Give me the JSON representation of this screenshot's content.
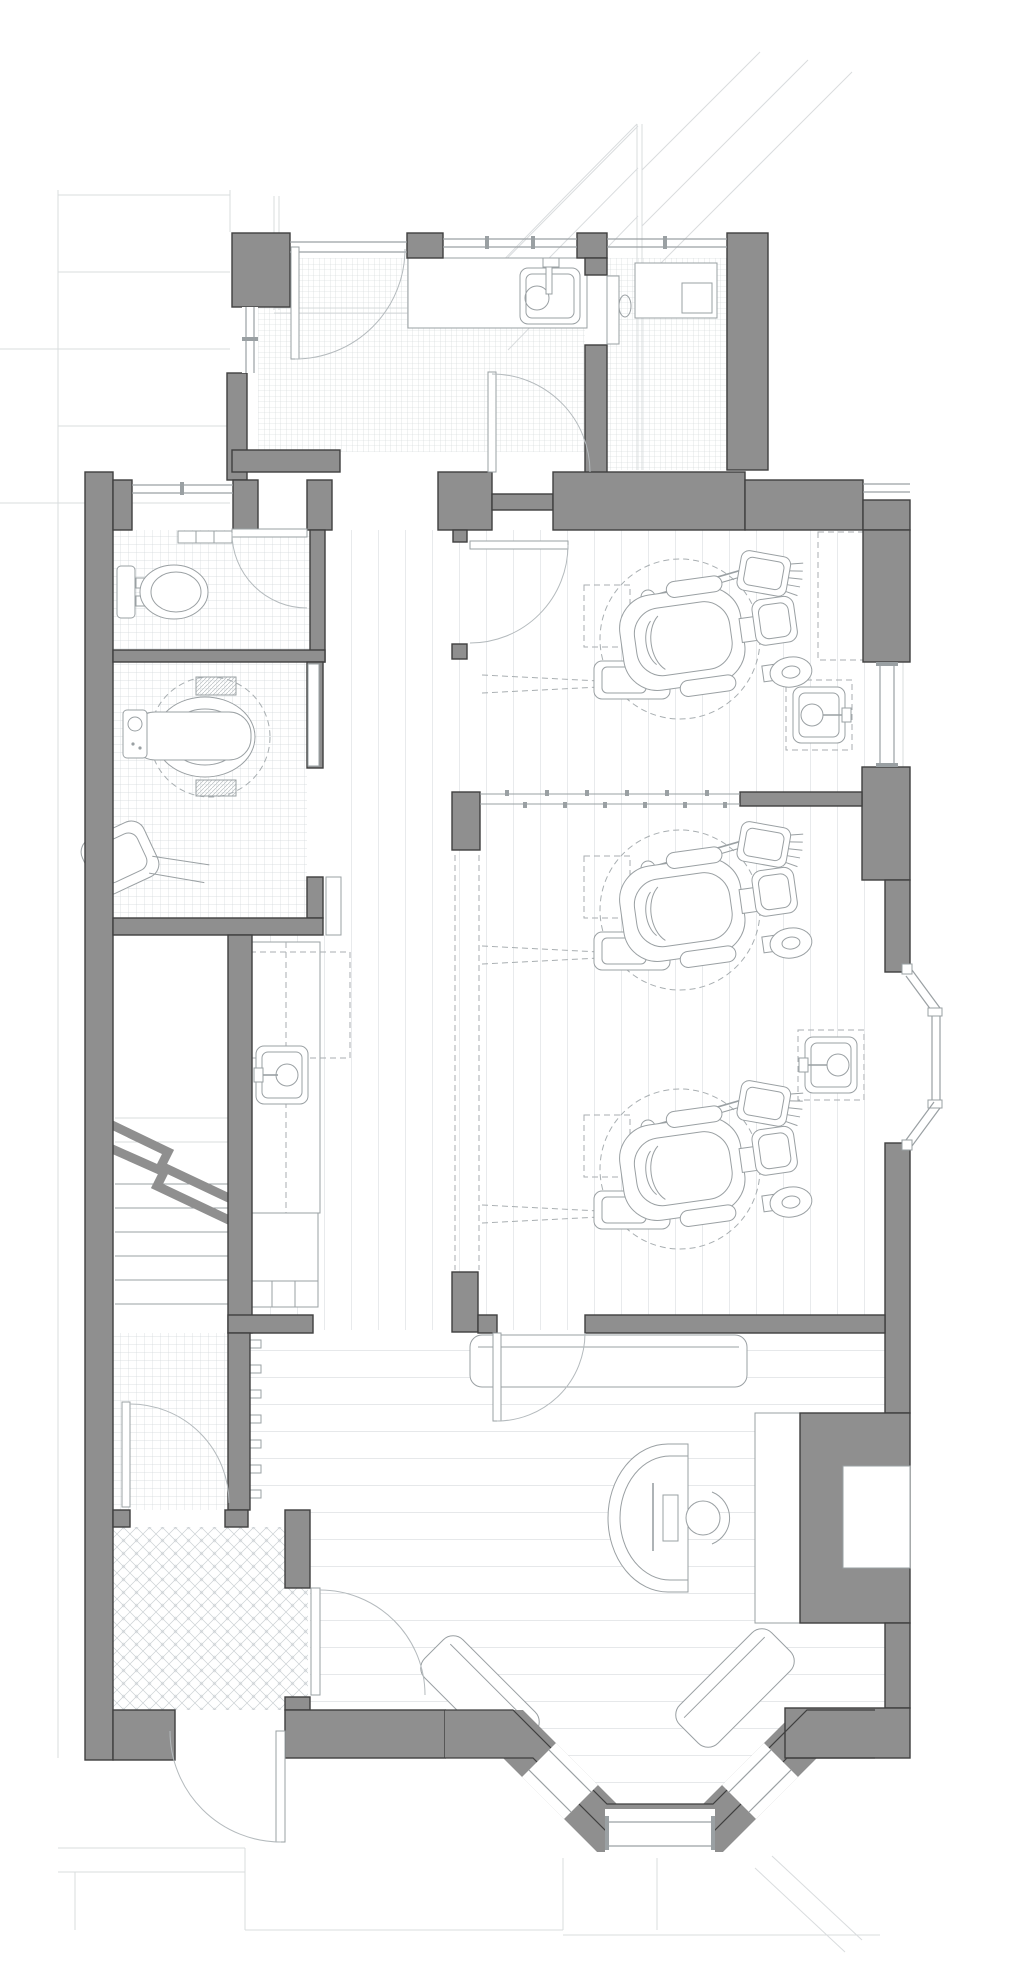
{
  "canvas": {
    "width": 1024,
    "height": 1987
  },
  "palette": {
    "background": "#ffffff",
    "wall_fill": "#8f8f8f",
    "wall_outline": "#3f3f3f",
    "fixture_line": "#9aa0a3",
    "dashed_line": "#a8aeb1",
    "swing_arc": "#b4babd",
    "context_faint": "#d9dcde",
    "tile_line": "#d2d7da",
    "plank_line": "#ccd1d4"
  },
  "fixtures": {
    "dental_chairs": [
      {
        "x": 570,
        "y": 557
      },
      {
        "x": 570,
        "y": 828
      },
      {
        "x": 570,
        "y": 1087
      }
    ],
    "coat_hooks": {
      "x": 250,
      "y_start": 1340,
      "count": 7,
      "spacing": 25,
      "w": 11,
      "h": 8
    }
  },
  "visible_text": []
}
